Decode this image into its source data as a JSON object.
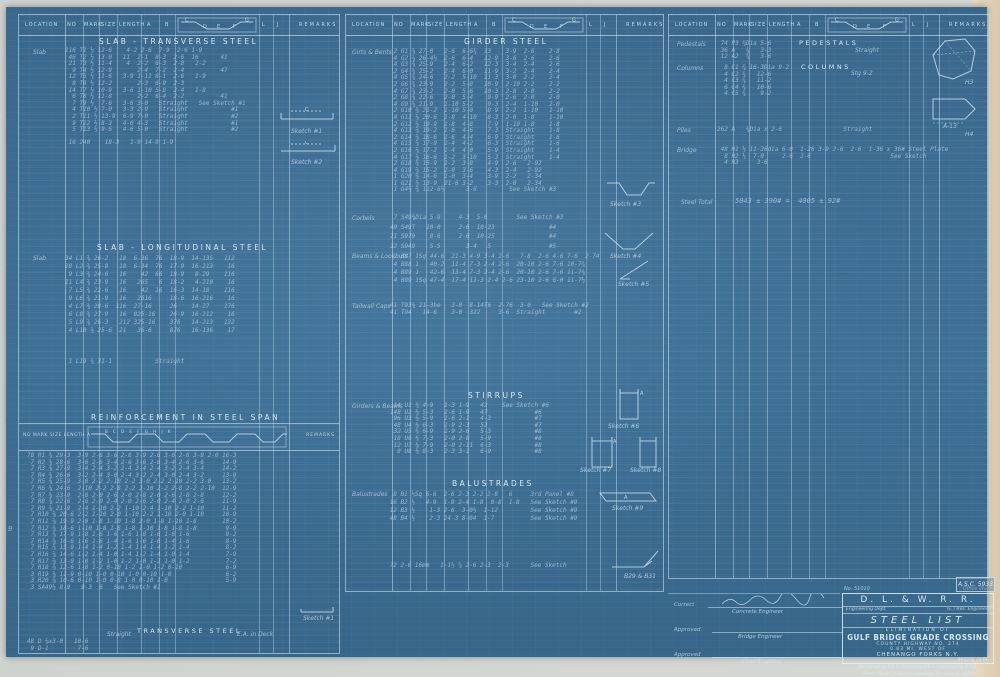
{
  "accent_colors": {
    "blueprint_blue": "#3d6d92",
    "line_white": "#d7edfa",
    "margin_tan": "#dcc9ab"
  },
  "table_header": {
    "location": "LOCATION",
    "no": "NO",
    "mark": "MARK",
    "size": "SIZE",
    "length": "LENGTH",
    "a": "A",
    "b": "B",
    "c": "C",
    "d": "D",
    "e": "E",
    "f": "F",
    "g": "G",
    "l": "L",
    "j": "J",
    "remarks": "REMARKS"
  },
  "left": {
    "transverse": {
      "title": "SLAB  -  TRANSVERSE  STEEL",
      "location_label": "Slab",
      "rows": "116 T1 ½ 12-6    4-2 2-6  7-9  2-6 1-9\n 46 T2 ½ 13-0   11  2-1  8-3  2-6  16      41\n 21 T3 ½ 11-4    4  2-2  6-3  2-8   2-2\n  9 T4 ½ 12-9       2-4  7-2  2-4          47\n 12 T5 ½ 11-6   3-9 1-11 6-1  2-6   1-9\n  8 T6 ½ 12-2       2-3  6-9  2-3\n 14 T7 ½ 10-9   3-6 1-10 5-8  2-4   1-8\n  6 T8 ½ 11-8       2-2  6-4  2-2          41\n  7 T9 ½  7-6   3-6 3-0   Straight   See Sketch #1\n  4 T10 ½ 7-0   3-3 2-9   Straight            #1\n  2 T11 ½ 13-9  6-9 7-0   Straight            #2\n  9 T12 ½ 8-3   4-0 4-3   Straight            #1\n  5 T13 ½ 9-6   4-6 5-0   Straight            #2\n\n 16 240    18-3   1-9 14-9 1-9"
    },
    "sketch1_label": "Sketch #1",
    "sketch2_label": "Sketch #2",
    "sketch_dim": "C",
    "longitudinal": {
      "title": "SLAB  -  LONGITUDINAL  STEEL",
      "location_label": "Slab",
      "rows": "34 L1 ⅝ 26-2   18  6-36  76  18-9  14-135   112\n18 L2 ⅝ 25-8   18  6-34  76  17-9  16-213    16\n 9 L3 ⅝ 24-6   16    42  66  18-9   8-29    116\n11 L4 ⅝ 23-9   16   265   6  18-2   4-210    16\n 7 L5 ⅝ 22-6   16    42  16  16-3  14-18    116\n 9 L6 ⅝ 21-9   16   2616     18-6  16-216    16\n 4 L7 ⅝ 28-6  116  27-16     26    14-27    176\n 6 L8 ⅝ 27-9   16  825-16    26-9  16-212    16\n 5 L9 ⅝ 26-3   212 325-16    376   14-213   132\n 4 L10 ⅝ 25-6  21   36-6     876   16-136    17",
      "single_row": " 1 L19 ⅝ 31-1            Straight"
    },
    "reinforcement": {
      "title": "REINFORCEMENT  IN  STEEL  SPAN",
      "head_labels": "NO MARK SIZE LENGTH A",
      "head_remarks": "REMARKS",
      "zigzag_letters": "B   C   D   E   F   G   H   J   K",
      "rows": "78 R1 ⅝ 29-3  3-9 2-6 3-6 2-6 3-9 2-6 3-6 2-6 3-9 2-0 16-3\n 7 R2 ⅝ 28-6  3-6 2-6 3-4 2-6 3-6 2-6 3-4 2-6 3-6     14-9\n 7 R3 ⅝ 27-9  3-4 2-4 3-2 2-4 3-4 2-4 3-2 2-4 3-4     14-2\n 7 R4 ⅝ 26-6  3-2 2-4 3-0 2-4 3-2 2-4 3-0 2-4 3-2     13-9\n 7 R5 ⅝ 25-9  3-0 2-2 2-10 2-2 3-0 2-2 2-10 2-2 3-0   13-2\n 7 R6 ⅝ 24-6  2-10 2-2 2-8 2-2 2-10 2-2 2-8 2-2 2-10  12-9\n 7 R7 ⅝ 23-9  2-8 2-0 2-6 2-0 2-8 2-0 2-6 2-0 2-8     12-2\n 7 R8 ⅝ 22-6  2-6 2-0 2-4 2-0 2-6 2-0 2-4 2-0 2-6     11-9\n 7 R9 ⅝ 21-9  2-4 1-10 2-2 1-10 2-4 1-10 2-2 1-10     11-2\n 7 R10 ⅝ 20-6 2-2 1-10 2-0 1-10 2-2 1-10 2-0 1-10     10-9\n 7 R11 ⅝ 19-9 2-0 1-8 1-10 1-8 2-0 1-8 1-10 1-8       10-2\n 7 R12 ⅝ 18-6 1-10 1-8 1-8 1-8 1-10 1-8 1-8 1-8        9-9\n 7 R13 ⅝ 17-9 1-8 1-6 1-6 1-6 1-8 1-6 1-6 1-6          9-2\n 7 R14 ⅝ 16-6 1-6 1-6 1-4 1-6 1-6 1-6 1-4 1-6          8-9\n 7 R15 ⅝ 15-9 1-4 1-4 1-2 1-4 1-4 1-4 1-2 1-4          8-2\n 7 R16 ⅝ 14-6 1-2 1-4 1-0 1-4 1-2 1-4 1-0 1-4          7-9\n 7 R17 ⅝ 13-9 1-0 1-2 1-0 1-2 1-0 1-2 1-0 1-2          7-2\n 7 R18 ⅝ 12-6 1-0 1-2 0-10 1-2 1-0 1-2 0-10            6-9\n 3 R19 ⅝ 11-9 0-10 1-0 0-10 1-0 0-10 1-0               6-2\n 3 R20 ⅝ 10-6 0-10 1-0 0-8 1-0 0-10 1-0                5-9\n 3 SA49½ 8-9   9-3  6   See Sketch #1",
      "footer_title": "TRANSVERSE  STEEL",
      "footer_left": "Straight",
      "footer_right": "E.A. in Deck",
      "bottom_rows": "48 D ⅛x3-0   10-6\n 9 D-1        7-6",
      "sketch_label": "Sketch #1"
    }
  },
  "middle": {
    "girder": {
      "title": "GIRDER  STEEL",
      "location_label": "Girts & Bents",
      "rows": " 2 G1 ⅝ 27-0   2-6  6-6¾  13    3-9  2-6    2-8\n 4 G2 ⅝ 26-4½  2-6  6-4   12-9  3-6  2-6    2-6\n 4 G3 ⅝ 25-9   2-4  6-2   12-3  3-4  2-4    2-6\n 2 G4 ⅝ 25-2   2-4  6-0   11-9  3-2  2-4    2-4\n 4 G5 ⅝ 24-6   2-2  5-10  11-3  3-0  2-2    2-4\n 2 G6 ⅝ 23-9   2-2  5-8   10-9  2-10 2-2    2-2\n 4 G7 ⅝ 23-2   2-0  5-6   10-3  2-8  2-0    2-2\n 2 G8 ⅝ 22-6   2-0  5-4    9-9  2-6  2-0    2-0\n 4 G9 ⅝ 21-9   1-10 5-2    9-3  2-4  1-10   2-0\n 2 G10 ⅝ 21-2  1-10 5-0    8-9  2-2  1-10   1-10\n 4 G11 ⅝ 20-6  1-8  4-10   8-3  2-0  1-8    1-10\n 2 G12 ⅝ 19-9  1-8  4-8    7-9  1-10 1-8    1-8\n 4 G13 ⅝ 19-2  1-6  4-6    7-3  Straight    1-8\n 2 G14 ⅝ 18-6  1-6  4-4    6-9  Straight    1-6\n 4 G15 ⅝ 17-9  1-4  4-2    6-3  Straight    1-6\n 2 G16 ⅝ 17-2  1-4  4-0    5-9  Straight    1-4\n 4 G17 ⅝ 16-6  1-2  3-10   5-3  Straight    1-4\n 2 G18 ⅝ 15-9  1-2  3-8    4-9  2-6   2-92\n 4 G19 ⅝ 15-2  1-0  3-6    4-3  2-4   2-92\n 1 G20 ⅝ 14-6  1-0  3-4    3-9  2-2   2-34\n 1 G21 ⅝ 13-9  21-6 3-2    3-3  2-0   2-34\n 1 G4½ ⅝ 112-6½      3-6         See Sketch #3",
      "corbels_label": "Corbels",
      "corbels_rows": " 7 S49⅜Dia 5-9     4-3  5-6        See Sketch #3\n49 S49T   10-0     2-6  10-23               #4\n21 S979    8-6     2-6  10-25               #4\n32 S949    5-5       3-4   5                #5",
      "beams_label": "Beams & Lookouts",
      "beams_rows": " 2 B87 1Sq 44-6  21-3 4-9 3-4 2-6   7-8  2-6 4-6 7-6  2-74\n 4 B88 1   40-2  11-4 7-3 2-4 2-6  20-10 2-6 7-6 10-7¾\n 4 B89 1   42-6  13-4 7-3 2-4 2-6  20-10 2-6 7-6 11-7¾\n 4 B89 1Sq 47-4  17-4 11-3 2-4 2-6 23-10 2-6 6-0 11-7½",
      "tailwall_label": "Tailwall Caps",
      "tailwall_rows": "41 T93⅜ 21-3he   3-0  8-14T6  2-76  3-0   See Sketch #2\n41 T94   14-6    3-0  322     3-6  Straight        #2",
      "sketch3_label": "Sketch #3",
      "sketch4_label": "Sketch #4",
      "sketch5_label": "Sketch #5"
    },
    "stirrups": {
      "title": "STIRRUPS",
      "location_label": "Girders & Beams",
      "rows": " 14 U1 ⅜ 4-9   1-3 1-9   42    See Sketch #6\n148 U2 ⅜ 5-3   1-6 1-9   47             #6\n 96 U3 ⅜ 5-9   1-6 2-1   4-3            #7\n 48 U4 ⅜ 6-3   1-9 2-3   52             #7\n 32 U5 ⅜ 6-9   1-9 2-6   5-3            #8\n 18 U6 ⅜ 7-3   2-0 2-8   5-9            #8\n 12 U7 ⅜ 7-9   2-0 2-11  6-3            #8\n  8 U8 ⅜ 8-3   2-3 3-1   6-9            #8",
      "sketch6_label": "Sketch #6",
      "sketch7_label": "Sketch #7",
      "sketch8_label": "Sketch #8"
    },
    "balustrades": {
      "title": "BALUSTRADES",
      "location_label": "Balustrades",
      "rows": "  8 B1 ½Sq 6-6  2-6 2-3 2-2 2-8   6     3rd Panel #8\n 16 B2 ½   4-9  1-9 2-4 1-8  0-8  1-8   See Sketch #9\n 12 B3 ½    1-3 2-6  3-0½  1-12         See Sketch #9\n 48 B4 ½    2-3 24-3 8-04  1-7          See Sketch #9",
      "rows2": " 72 2-6 16mm   1-1½ ⅞ 2-6 2-3  2-3      See Sketch",
      "sketch9_label": "Sketch #9",
      "bottom_sketch_label": "B29 & B31"
    }
  },
  "right": {
    "pedestals": {
      "title": "PEDESTALS",
      "note": "Straight",
      "location_label": "Pedestals",
      "rows": " 74 P3 ¾Dia 5-6\n 36 A   ¾   3-3\n 12 A2  ¾   3-6"
    },
    "columns": {
      "title": "COLUMNS",
      "note": "Stg 9-2",
      "location_label": "Columns",
      "rows": "  8 C1 ¾ 16-3Dia 9-2\n  4 C2 ¾   12-6\n  4 C3 ¾   11-2\n  6 C4 ¾   10-6\n  4 C5 ¾    9-2"
    },
    "piles": {
      "location_label": "Piles",
      "row": "262 A   ¾Dia x 2-6                 Straight"
    },
    "bridge": {
      "location_label": "Bridge",
      "rows": " 48 H1 ½ 11-26dia 6-0  1-26 3-9 2-6  2-6  1-36 x 36# Steel Plate\n  8 H2 ½  7-0     2-6  2-6                      See Sketch\n  4 H3     3-6"
    },
    "steel_total": {
      "label": "Steel Total",
      "value": "5043 ± 390# =  4005 ± 92#"
    },
    "h3_label": "H3",
    "h4_label": "H4",
    "h4_dim": "A-13"
  },
  "title_block": {
    "top_left": "No. 51010",
    "top_right": "Office Work",
    "railroad": "D. L. & W. R. R.",
    "sub_left": "Engineering Dept.",
    "sub_right": "G. / Res. Engineers",
    "doc_title": "STEEL  LIST",
    "elimination": "ELIMINATION OF",
    "project": "GULF BRIDGE GRADE CROSSING",
    "highway": "COUNTY HIGHWAY NO. 274",
    "miles": "0.83 MI. WEST OF",
    "place": "CHENANGO FORKS N.Y.",
    "dept": "BRIDGE DEPT.",
    "credits": "Designed by F.E.T.  Traced by F.E.T.  Checked by C.T.S.",
    "sheet_line": "Sheet 10 of 12 Sheets  Hoboken N.J.  June 6, 1934",
    "drawing_no": "A.S.C. 5933"
  },
  "approvals": {
    "correct_label": "Correct",
    "approved1_label": "Approved",
    "approved2_label": "Approved",
    "role1": "Concrete Engineer",
    "role2": "Bridge Engineer",
    "role3": "Chief Engineer"
  },
  "stray_mark": "9"
}
